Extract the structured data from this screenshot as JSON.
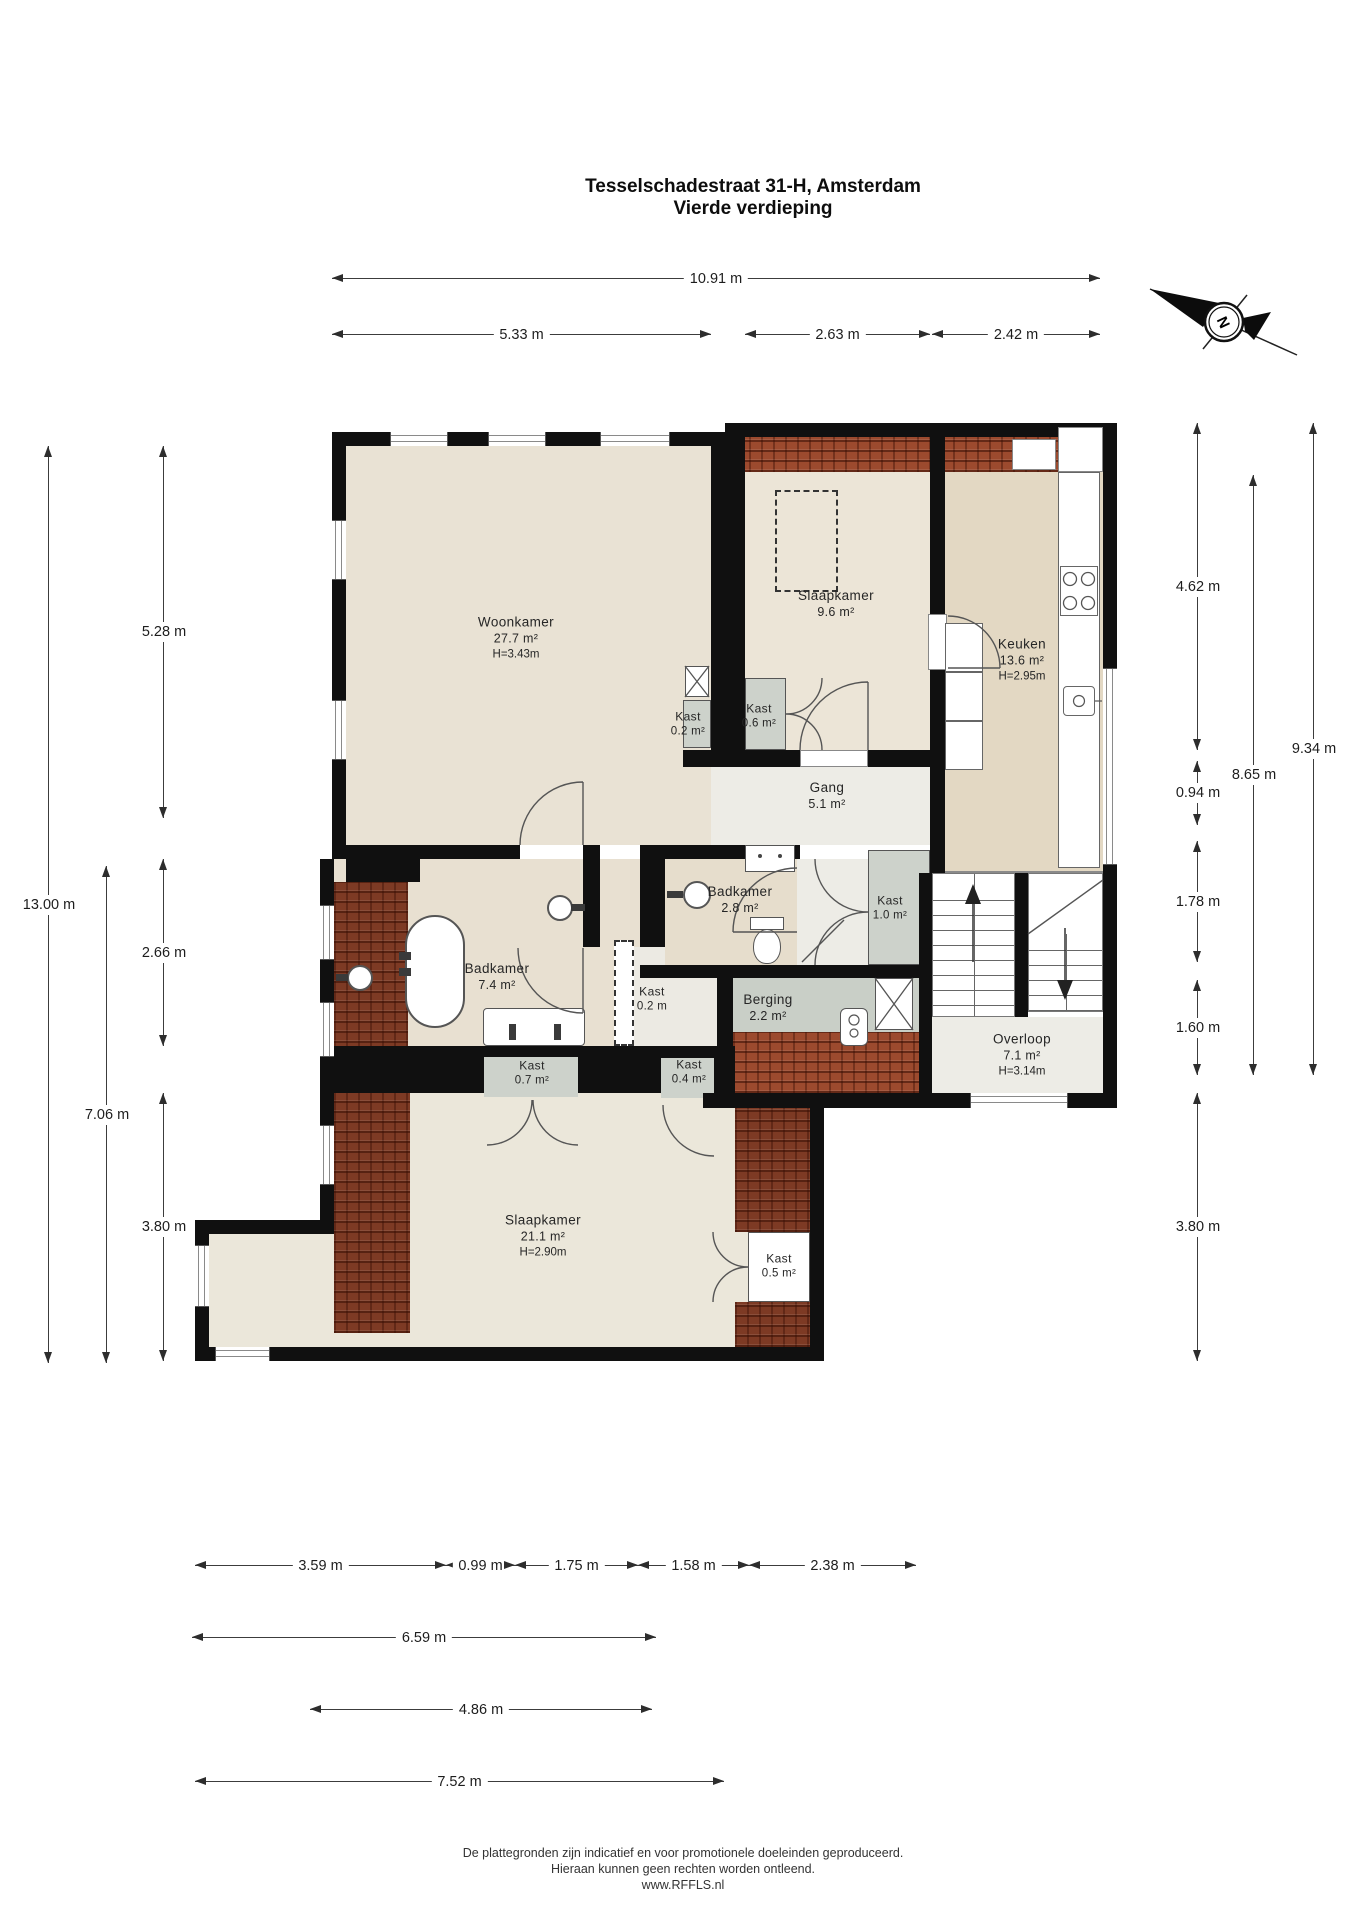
{
  "title": {
    "address": "Tesselschadestraat 31-H, Amsterdam",
    "floor": "Vierde verdieping"
  },
  "compass": {
    "north_label": "N"
  },
  "rooms": {
    "woonkamer": {
      "name": "Woonkamer",
      "area": "27.7 m²",
      "height": "H=3.43m"
    },
    "slaapkamer_boven": {
      "name": "Slaapkamer",
      "area": "9.6 m²"
    },
    "keuken": {
      "name": "Keuken",
      "area": "13.6 m²",
      "height": "H=2.95m"
    },
    "gang": {
      "name": "Gang",
      "area": "5.1 m²"
    },
    "badkamer_klein": {
      "name": "Badkamer",
      "area": "2.8 m²"
    },
    "badkamer_groot": {
      "name": "Badkamer",
      "area": "7.4 m²"
    },
    "berging": {
      "name": "Berging",
      "area": "2.2 m²"
    },
    "overloop": {
      "name": "Overloop",
      "area": "7.1 m²",
      "height": "H=3.14m"
    },
    "slaapkamer_beneden": {
      "name": "Slaapkamer",
      "area": "21.1 m²",
      "height": "H=2.90m"
    },
    "kast_woonkamer": {
      "name": "Kast",
      "area": "0.2 m²"
    },
    "kast_slaapkamer_boven": {
      "name": "Kast",
      "area": "0.6 m²"
    },
    "kast_overloop": {
      "name": "Kast",
      "area": "1.0 m²"
    },
    "kast_badkamer": {
      "name": "Kast",
      "area": "0.2 m"
    },
    "kast_wastafel": {
      "name": "Kast",
      "area": "0.7 m²"
    },
    "kast_berging": {
      "name": "Kast",
      "area": "0.4 m²"
    },
    "kast_slaapkamer_beneden": {
      "name": "Kast",
      "area": "0.5 m²"
    }
  },
  "dimensions": {
    "total_width": "10.91 m",
    "w_woonkamer": "5.33 m",
    "w_slaapkamer": "2.63 m",
    "w_keuken": "2.42 m",
    "h_total_left": "13.00 m",
    "h_left_lower": "7.06 m",
    "h_woonkamer": "5.28 m",
    "h_badkamer": "2.66 m",
    "h_slaapkamer_left": "3.80 m",
    "h_keuken_right": "4.62 m",
    "h_right_094": "0.94 m",
    "h_right_178": "1.78 m",
    "h_overloop": "1.60 m",
    "h_slaapkamer_right": "3.80 m",
    "h_right_inner": "8.65 m",
    "h_right_outer": "9.34 m",
    "b_359": "3.59 m",
    "b_099": "0.99 m",
    "b_175": "1.75 m",
    "b_158": "1.58 m",
    "b_238": "2.38 m",
    "b_659": "6.59 m",
    "b_486": "4.86 m",
    "b_752": "7.52 m"
  },
  "footer": {
    "line1": "De plattegronden zijn indicatief en voor promotionele doeleinden geproduceerd.",
    "line2": "Hieraan kunnen geen rechten worden ontleend.",
    "line3": "www.RFFLS.nl"
  },
  "colors": {
    "wall": "#101010",
    "floor_light": "#e9e2d4",
    "floor_kitchen": "#e3d8c3",
    "floor_hall": "#edece6",
    "closet_gray": "#cdd2cb",
    "roof_tiles": "#9c4a2e",
    "roof_tiles_dark": "#7d3a24"
  }
}
